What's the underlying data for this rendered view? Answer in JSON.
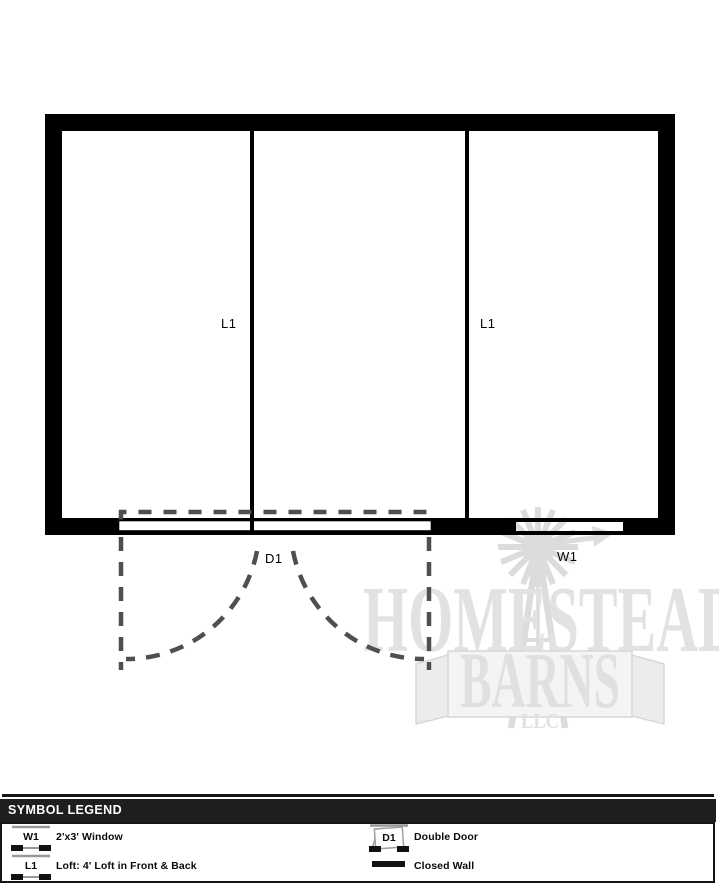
{
  "plan": {
    "loft_left_label": "L1",
    "loft_right_label": "L1",
    "door_label": "D1",
    "window_label": "W1"
  },
  "watermark": {
    "word_top": "HOMESTEAD",
    "word_main": "BARNS",
    "word_sub": "LLC"
  },
  "legend": {
    "title": "SYMBOL LEGEND",
    "items": [
      {
        "symbol": "W1",
        "label": "2'x3' Window"
      },
      {
        "symbol": "L1",
        "label": "Loft: 4' Loft in Front & Back"
      },
      {
        "symbol": "D1",
        "label": "Double Door"
      },
      {
        "label": "Closed Wall"
      }
    ]
  },
  "colors": {
    "wall": "#000000",
    "dashed_gray": "#4f4f4f",
    "watermark_gray": "#e2e2e2",
    "legend_bar_bg": "#1e1e1e"
  }
}
